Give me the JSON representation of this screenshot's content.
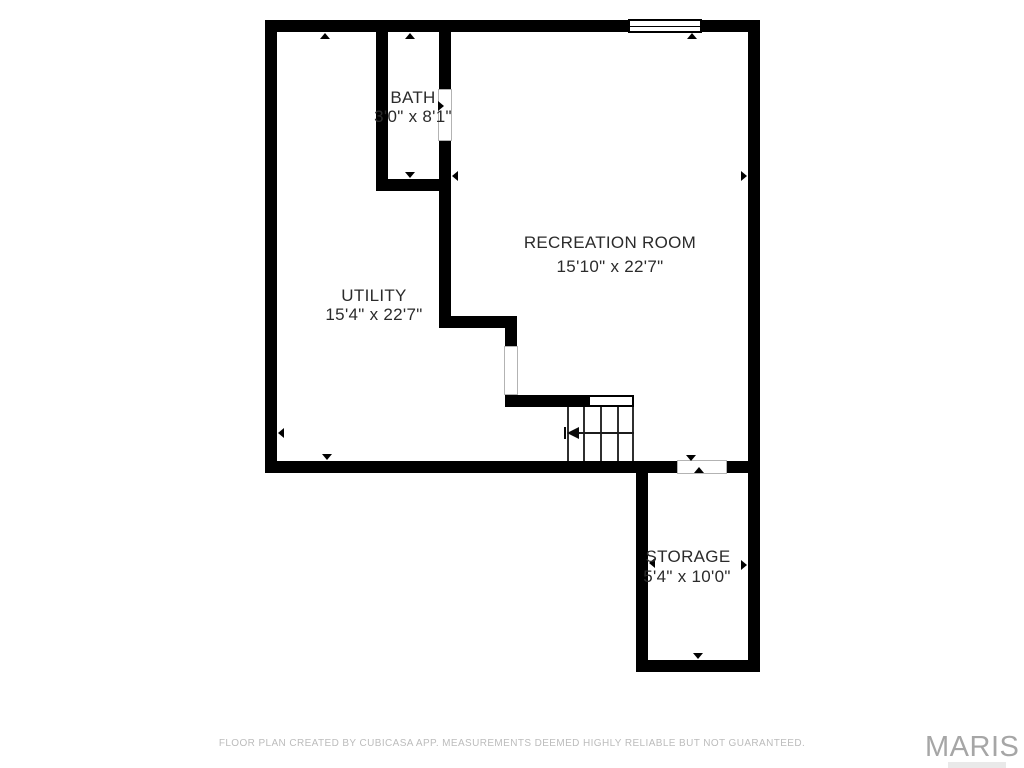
{
  "plan": {
    "rooms": [
      {
        "name": "BATH",
        "dimensions": "3'0\" x 8'1\""
      },
      {
        "name": "RECREATION ROOM",
        "dimensions": "15'10\" x 22'7\""
      },
      {
        "name": "UTILITY",
        "dimensions": "15'4\" x 22'7\""
      },
      {
        "name": "STORAGE",
        "dimensions": "5'4\" x 10'0\""
      }
    ]
  },
  "footer": {
    "disclaimer": "FLOOR PLAN CREATED BY CUBICASA APP. MEASUREMENTS DEEMED HIGHLY RELIABLE BUT NOT GUARANTEED.",
    "watermark": "MARIS"
  },
  "colors": {
    "wall": "#000000",
    "room_text": "#2b2b2b",
    "disclaimer_text": "#bcbcbc",
    "watermark_text": "#a6a6a6"
  }
}
